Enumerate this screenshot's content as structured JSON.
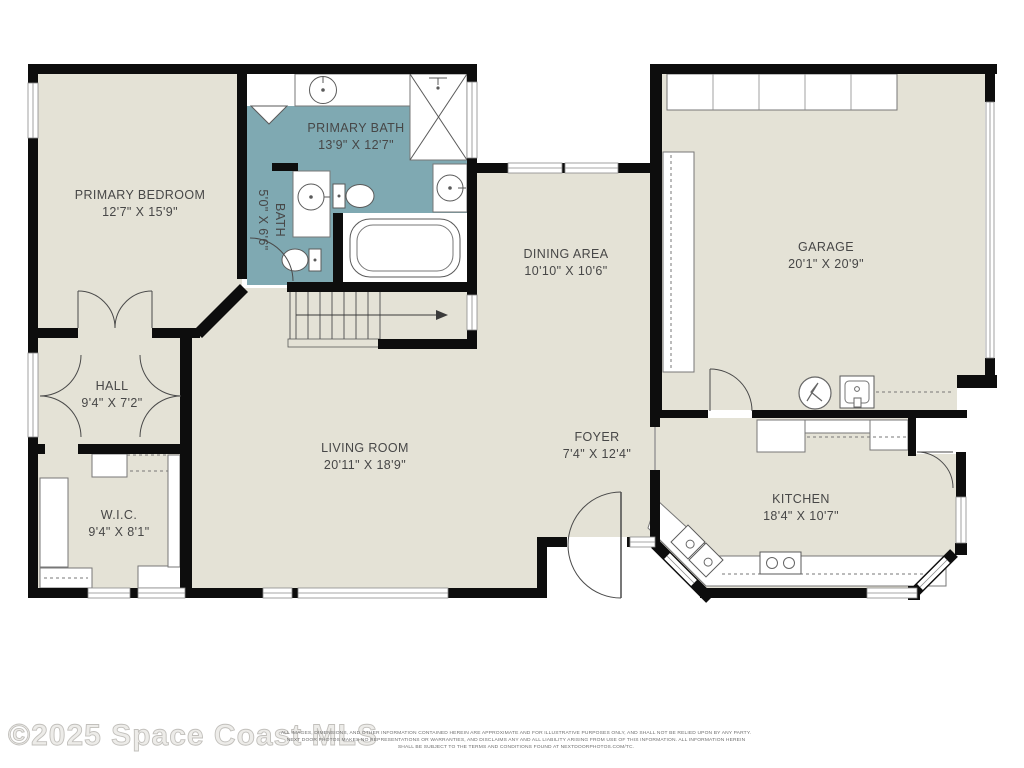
{
  "watermark": "©2025 Space Coast MLS",
  "disclaimer": {
    "line1": "ALL IMAGES, DIMENSIONS, AND OTHER INFORMATION CONTAINED HEREIN ARE APPROXIMATE AND FOR ILLUSTRATIVE PURPOSES ONLY, AND SHALL NOT BE RELIED UPON BY ANY PARTY.",
    "line2": "NEXT DOOR PHOTOS MAKES NO REPRESENTATIONS OR WARRANTIES, AND DISCLAIMS ANY AND ALL LIABILITY ARISING FROM USE OF THIS INFORMATION. ALL INFORMATION HEREIN",
    "line3": "SHALL BE SUBJECT TO THE TERMS AND CONDITIONS FOUND AT NEXTDOORPHOTOS.COM/TC."
  },
  "rooms": {
    "primary_bedroom": {
      "name": "PRIMARY BEDROOM",
      "dims": "12'7\" X 15'9\""
    },
    "primary_bath": {
      "name": "PRIMARY BATH",
      "dims": "13'9\" X 12'7\""
    },
    "bath": {
      "name": "BATH",
      "dims": "5'0\" X 6'6\""
    },
    "hall": {
      "name": "HALL",
      "dims": "9'4\" X 7'2\""
    },
    "wic": {
      "name": "W.I.C.",
      "dims": "9'4\" X 8'1\""
    },
    "living_room": {
      "name": "LIVING ROOM",
      "dims": "20'11\" X 18'9\""
    },
    "dining_area": {
      "name": "DINING AREA",
      "dims": "10'10\" X 10'6\""
    },
    "foyer": {
      "name": "FOYER",
      "dims": "7'4\" X 12'4\""
    },
    "kitchen": {
      "name": "KITCHEN",
      "dims": "18'4\" X 10'7\""
    },
    "garage": {
      "name": "GARAGE",
      "dims": "20'1\" X 20'9\""
    }
  },
  "colors": {
    "floor": "#e4e2d6",
    "bath_floor": "#7fa9b2",
    "wall": "#0d0d0d",
    "label_text": "#474747",
    "watermark_text": "#d5d4d0",
    "disclaimer_text": "#6e6e6e"
  },
  "icons": [
    "sink-icon",
    "toilet-icon",
    "bathtub-icon",
    "shower-icon",
    "stairs-icon",
    "door-arc-icon",
    "window-icon",
    "water-heater-icon",
    "laundry-tub-icon",
    "stove-icon",
    "fridge-icon",
    "double-sink-icon"
  ]
}
